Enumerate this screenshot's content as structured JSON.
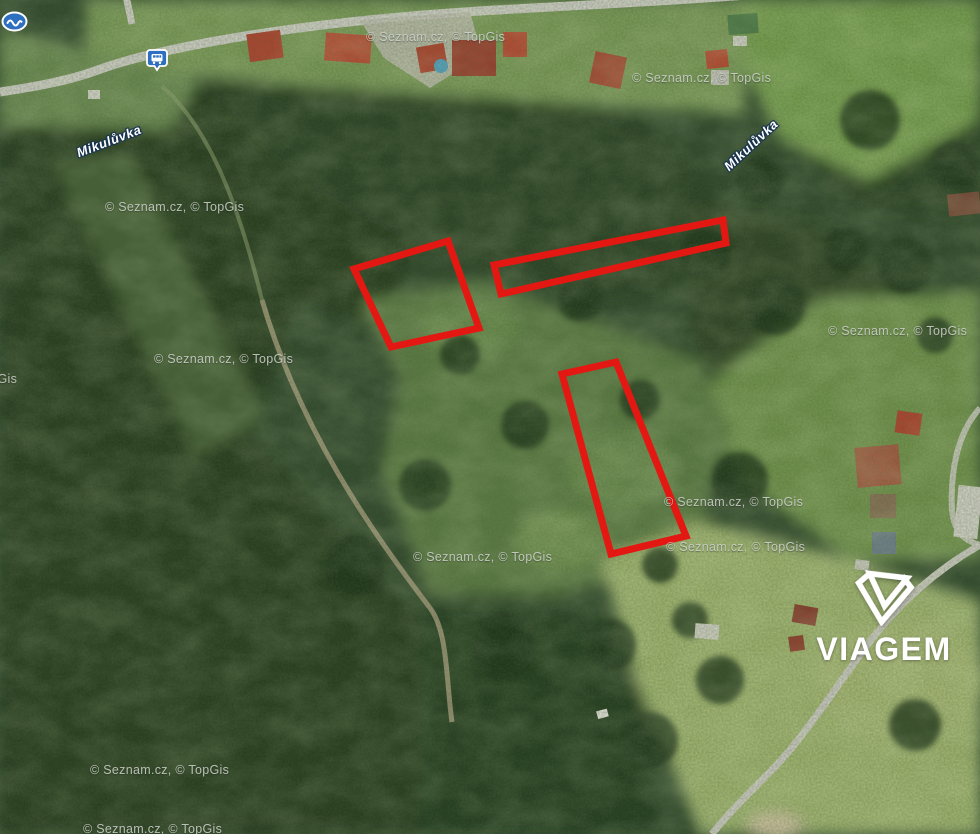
{
  "map": {
    "watermark": {
      "text": "© Seznam.cz, © TopGis",
      "instances": [
        {
          "x": 105,
          "y": 200
        },
        {
          "x": 366,
          "y": 30
        },
        {
          "x": 632,
          "y": 71
        },
        {
          "x": 154,
          "y": 352
        },
        {
          "x": -122,
          "y": 372
        },
        {
          "x": 828,
          "y": 324
        },
        {
          "x": 664,
          "y": 495
        },
        {
          "x": 413,
          "y": 550
        },
        {
          "x": 666,
          "y": 540
        },
        {
          "x": 90,
          "y": 763
        },
        {
          "x": 83,
          "y": 822
        }
      ]
    },
    "place_labels": [
      {
        "text": "Mikulůvka",
        "x": 109,
        "y": 141,
        "angle": -21
      },
      {
        "text": "Mikulůvka",
        "x": 751,
        "y": 145,
        "angle": -43
      }
    ],
    "poi_icons": [
      {
        "id": "bus-stop",
        "name": "bus-stop-icon",
        "x": 146,
        "y": 49
      },
      {
        "id": "poi-badge",
        "name": "transit-poi-icon",
        "x": 1,
        "y": 11
      }
    ],
    "parcels": {
      "outline_color": "#e41812",
      "stroke_width": 7,
      "polygons": [
        {
          "id": "parcel-outline-1",
          "points": "354,269 448,241 479,328 391,347"
        },
        {
          "id": "parcel-outline-2",
          "points": "494,265 723,220 726,243 501,294"
        },
        {
          "id": "parcel-outline-3",
          "points": "562,374 616,362 686,536 611,554"
        }
      ]
    },
    "brand": {
      "name": "VIAGEM",
      "color": "#ffffff"
    }
  }
}
